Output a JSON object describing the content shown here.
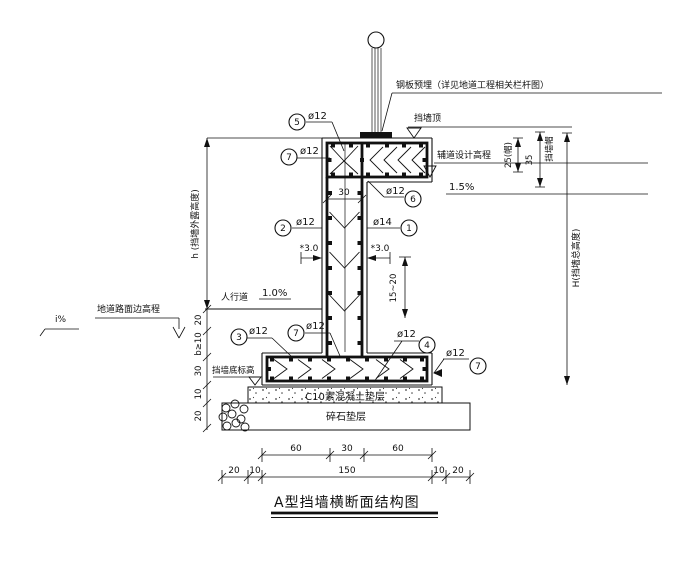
{
  "title": {
    "text": "A型挡墙横断面结构图"
  },
  "callouts": {
    "plate": "钢板预埋（详见地道工程相关栏杆图）",
    "wall_top": "挡墙顶",
    "aux_road_elevation": "辅道设计高程",
    "aux_road_slope": "1.5%",
    "sidewalk": "人行道",
    "sidewalk_slope": "1.0%",
    "road_edge_elevation": "地道路面边高程",
    "road_slope": "i%",
    "wall_bottom_elevation": "挡墙底标高",
    "c10_layer": "C10素混凝土垫层",
    "gravel_layer": "碎石垫层",
    "wall_cap": "挡墙帽"
  },
  "dimensions": {
    "h_exposed": "h (挡墙外露高度)",
    "H_total": "H(挡墙总高度)",
    "cap_25": "25(帽)",
    "cap_35": "35",
    "stem_width": "30",
    "left_chain": [
      "20",
      "b≥10",
      "30",
      "10",
      "20"
    ],
    "bottom_row1": [
      "60",
      "30",
      "60"
    ],
    "bottom_row2": [
      "20",
      "10",
      "150",
      "10",
      "20"
    ],
    "cover_left": "*3.0",
    "cover_right": "*3.0",
    "stirrup_spacing": "15~20"
  },
  "rebar": {
    "r1": {
      "num": "1",
      "size": "ø14"
    },
    "r2": {
      "num": "2",
      "size": "ø12"
    },
    "r3": {
      "num": "3",
      "size": "ø12"
    },
    "r4": {
      "num": "4",
      "size": "ø12"
    },
    "r5": {
      "num": "5",
      "size": "ø12"
    },
    "r6": {
      "num": "6",
      "size": "ø12"
    },
    "r7": {
      "num": "7",
      "size": "ø12"
    }
  }
}
